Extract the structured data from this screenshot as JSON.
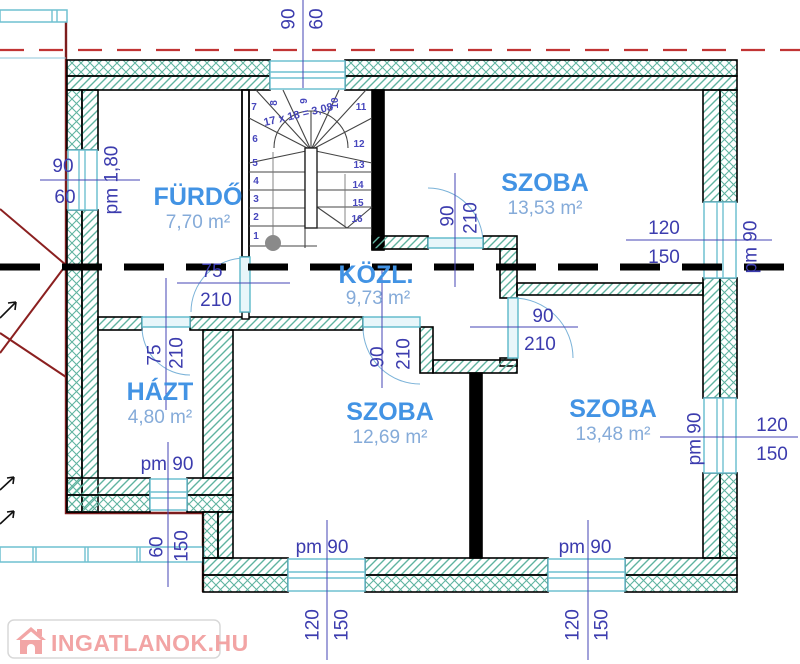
{
  "watermark": {
    "text": "INGATLANOK.HU"
  },
  "rooms": {
    "furdo": {
      "name": "FÜRDŐ",
      "area": "7,70 m²"
    },
    "szoba_top": {
      "name": "SZOBA",
      "area": "13,53 m²"
    },
    "kozl": {
      "name": "KÖZL.",
      "area": "9,73 m²"
    },
    "hazt": {
      "name": "HÁZT",
      "area": "4,80 m²"
    },
    "szoba_bottom_left": {
      "name": "SZOBA",
      "area": "12,69 m²"
    },
    "szoba_bottom_right": {
      "name": "SZOBA",
      "area": "13,48 m²"
    }
  },
  "stairs": {
    "formula": "17 x 18 = 3,08",
    "steps": [
      "1",
      "2",
      "3",
      "4",
      "5",
      "6",
      "7",
      "8",
      "9",
      "10",
      "11",
      "12",
      "13",
      "14",
      "15",
      "16"
    ]
  },
  "dimensions": {
    "top_window": {
      "width": "90",
      "depth": "60"
    },
    "left_window": {
      "width": "90",
      "depth": "60",
      "parapet": "pm 1,80"
    },
    "right_window_top": {
      "width": "120",
      "height": "150",
      "parapet": "pm 90"
    },
    "right_window_bottom": {
      "width": "120",
      "height": "150",
      "parapet": "pm 90"
    },
    "hazt_window": {
      "parapet": "pm 90"
    },
    "bottom_window_left": {
      "parapet": "pm 90",
      "width": "120",
      "height": "150"
    },
    "bottom_window_right": {
      "parapet": "pm 90",
      "width": "120",
      "height": "150"
    },
    "terrace": {
      "width": "60",
      "depth": "150"
    },
    "door_furdo": {
      "width": "75",
      "height": "210"
    },
    "door_hazt": {
      "width": "75",
      "height": "210"
    },
    "door_szoba_top": {
      "width": "90",
      "height": "210"
    },
    "door_szoba_bl": {
      "width": "90",
      "height": "210"
    },
    "door_szoba_br": {
      "width": "90",
      "height": "210"
    }
  },
  "colors": {
    "hatch": "#5fb3a0",
    "dimension_text": "#3c3cae",
    "room_label": "#4293e4",
    "section_red": "#c13434",
    "lower_level_red": "#7d1d1d",
    "window_cyan": "#6fc0d0",
    "watermark_pink": "#f2a4a4"
  }
}
